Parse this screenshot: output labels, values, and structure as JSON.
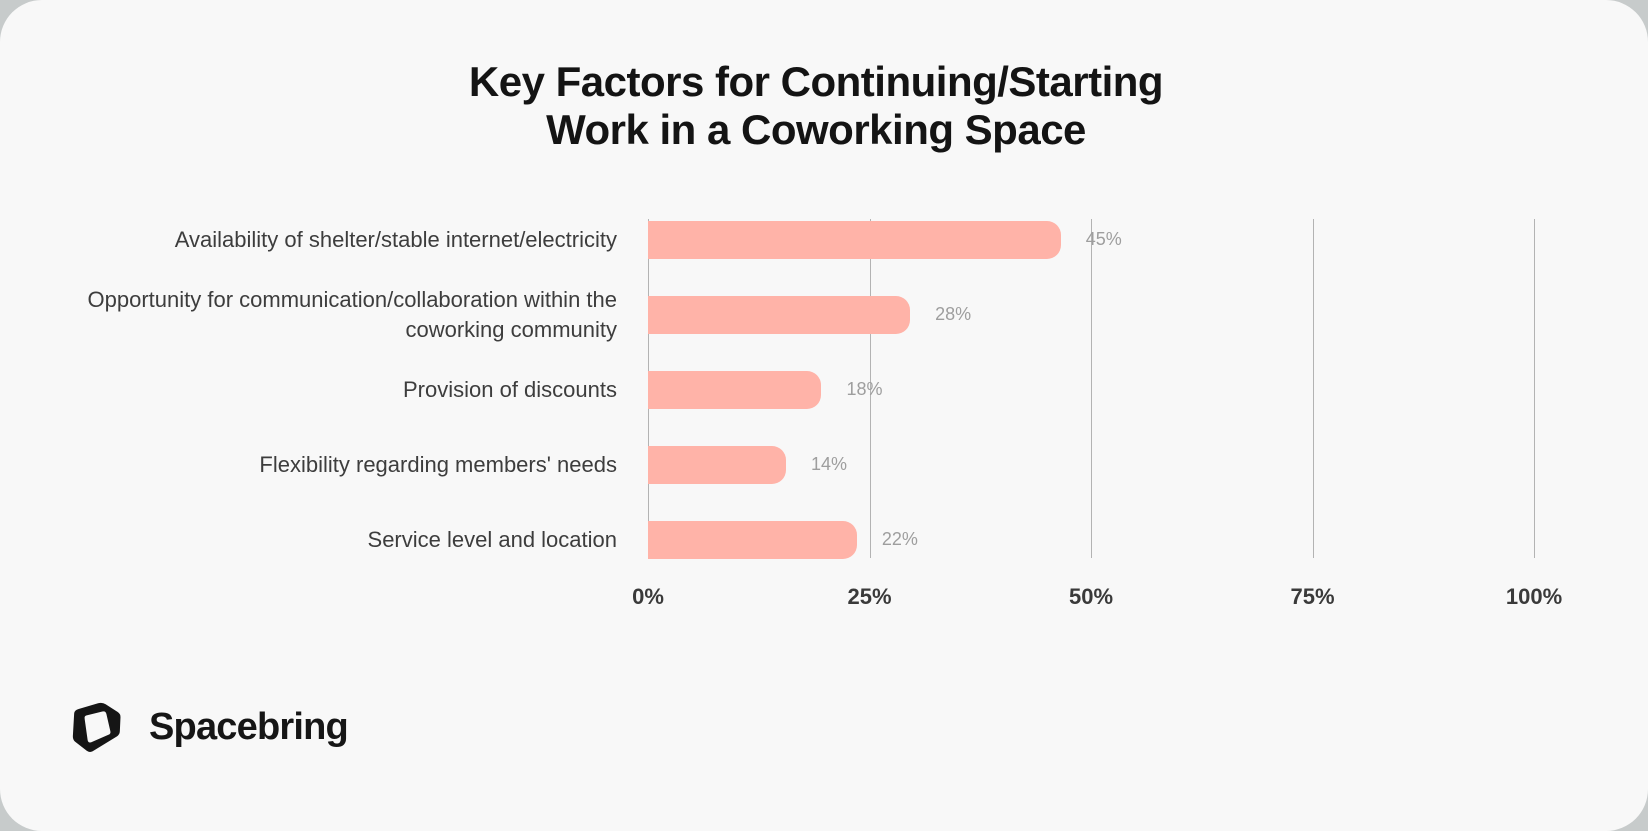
{
  "colors": {
    "outer_background": "#c7cbcb",
    "card_background": "#f8f8f8",
    "bar": "#ffb3a8",
    "gridline": "#b3b3b3",
    "title_text": "#141414",
    "category_text": "#3d3d3d",
    "tick_text": "#3a3a3a",
    "value_text": "#9e9e9e",
    "brand_text": "#161616"
  },
  "title": {
    "line1": "Key Factors for Continuing/Starting",
    "line2": "Work in a Coworking Space"
  },
  "chart_data": {
    "type": "bar",
    "orientation": "horizontal",
    "title": "Key Factors for Continuing/Starting Work in a Coworking Space",
    "categories": [
      "Availability of shelter/stable internet/electricity",
      "Opportunity for communication/collaboration within the coworking community",
      "Provision of discounts",
      "Flexibility regarding members' needs",
      "Service level and location"
    ],
    "values": [
      45,
      28,
      18,
      14,
      22
    ],
    "value_labels": [
      "45%",
      "28%",
      "18%",
      "14%",
      "22%"
    ],
    "x_ticks": [
      "0%",
      "25%",
      "50%",
      "75%",
      "100%"
    ],
    "x_tick_positions": [
      0,
      25,
      50,
      75,
      100
    ],
    "xlim": [
      0,
      100
    ],
    "grid": true,
    "legend": false,
    "bar_color": "#ffb3a8",
    "value_label_position": "right-of-bar"
  },
  "footer": {
    "brand": "Spacebring",
    "logo": "spacebring-cube-logo"
  }
}
